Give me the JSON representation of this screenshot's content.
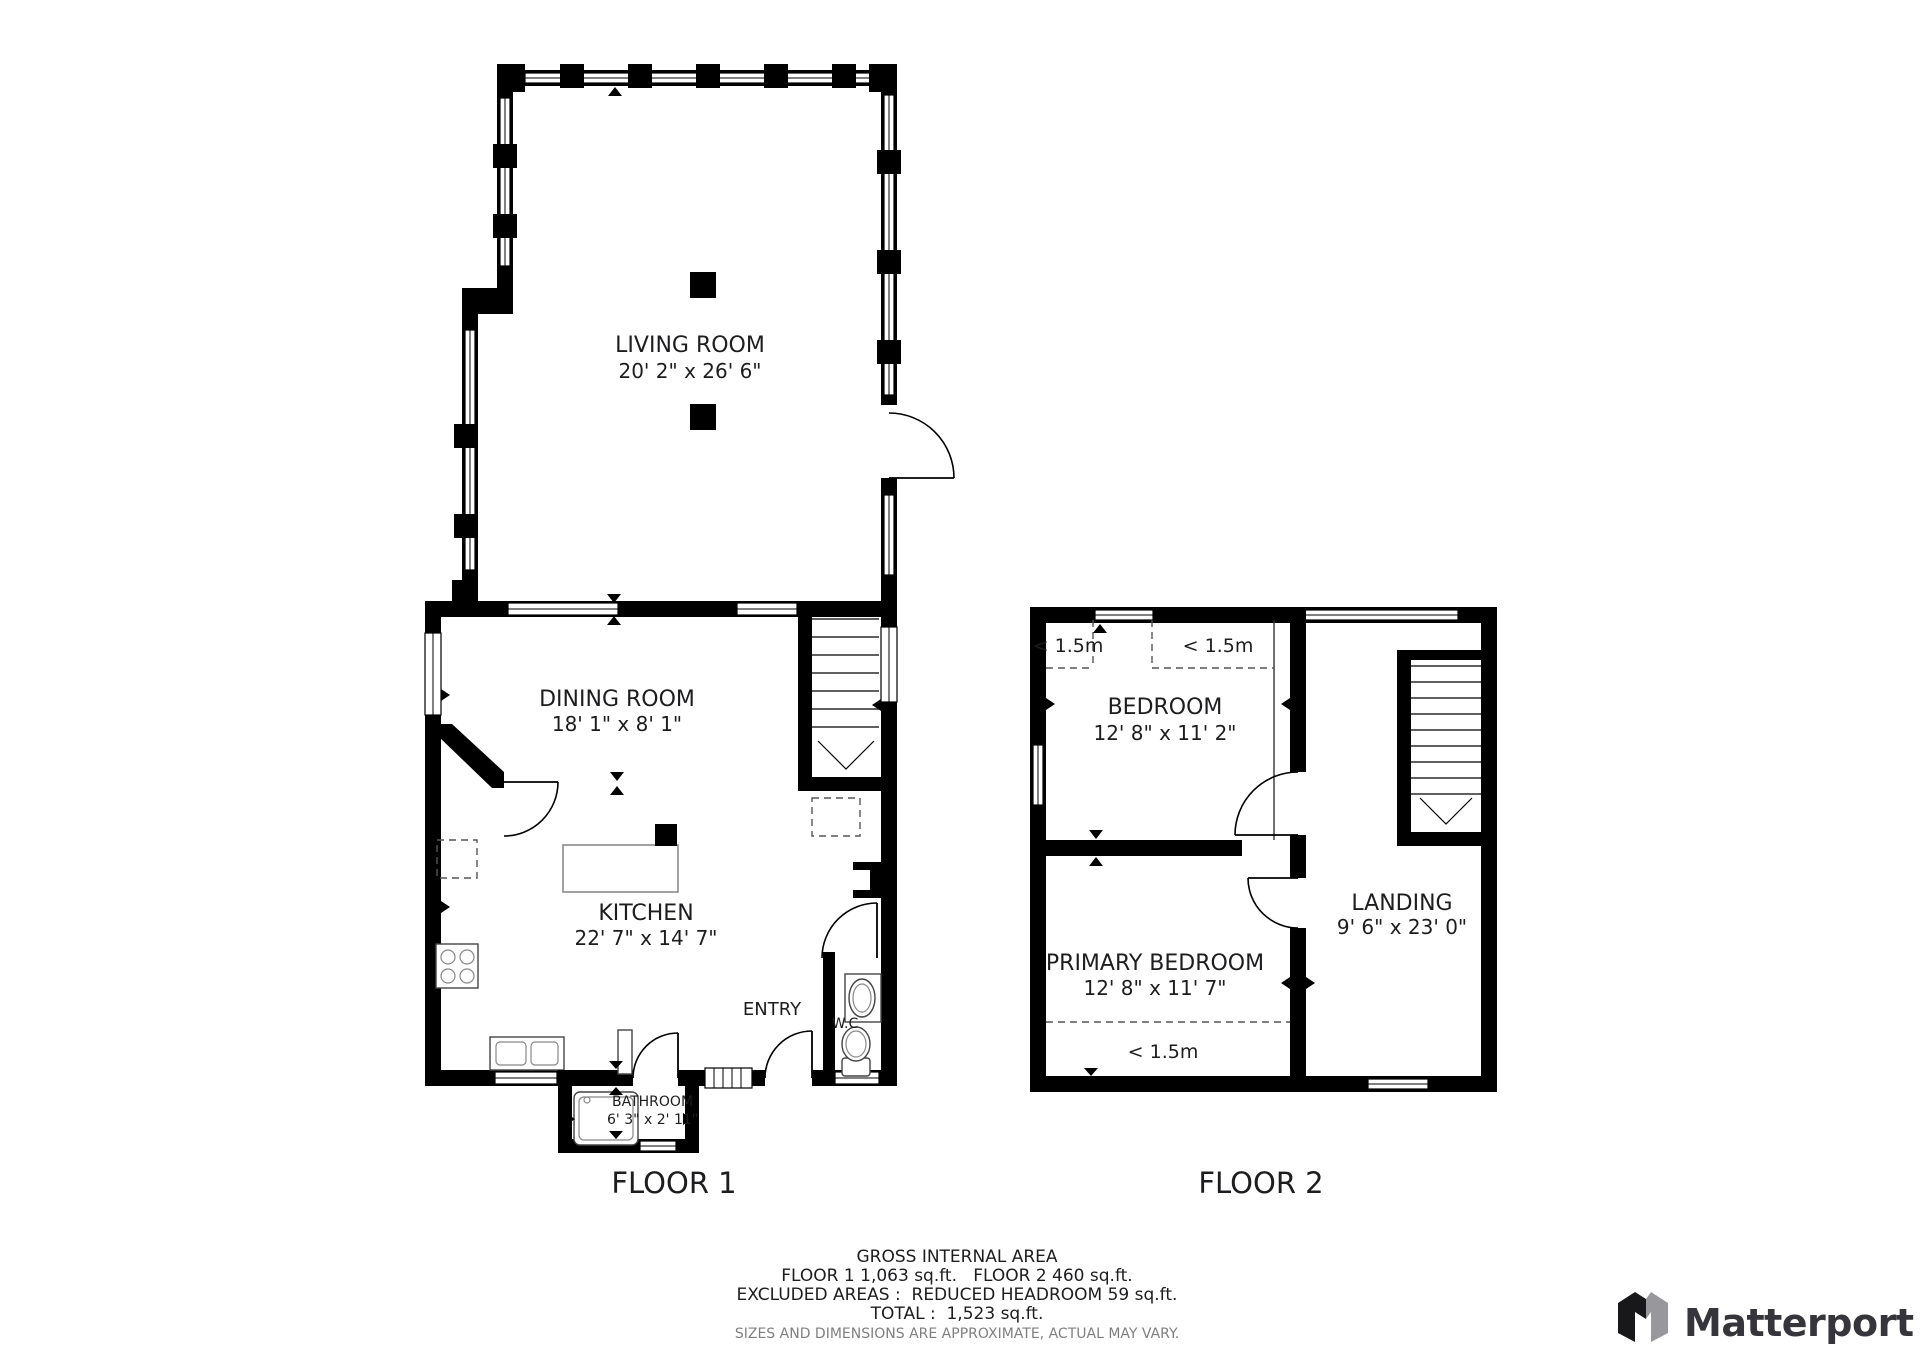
{
  "floor1": {
    "label": "FLOOR 1",
    "living_room": {
      "name": "LIVING ROOM",
      "dims": "20' 2\" x 26' 6\""
    },
    "dining_room": {
      "name": "DINING ROOM",
      "dims": "18' 1\" x 8' 1\""
    },
    "kitchen": {
      "name": "KITCHEN",
      "dims": "22' 7\" x 14' 7\""
    },
    "entry": {
      "name": "ENTRY"
    },
    "wc": {
      "name": "W.C"
    },
    "bathroom": {
      "name": "BATHROOM",
      "dims": "6' 3\" x 2' 11\""
    }
  },
  "floor2": {
    "label": "FLOOR 2",
    "bedroom": {
      "name": "BEDROOM",
      "dims": "12' 8\" x 11' 2\""
    },
    "primary_bedroom": {
      "name": "PRIMARY BEDROOM",
      "dims": "12' 8\" x 11' 7\""
    },
    "landing": {
      "name": "LANDING",
      "dims": "9' 6\" x 23' 0\""
    },
    "headroom_left": "< 1.5m",
    "headroom_center": "< 1.5m",
    "headroom_bottom": "< 1.5m"
  },
  "footer": {
    "title": "GROSS INTERNAL AREA",
    "line1": "FLOOR 1 1,063 sq.ft.   FLOOR 2 460 sq.ft.",
    "line2": "EXCLUDED AREAS :  REDUCED HEADROOM 59 sq.ft.",
    "line3": "TOTAL :  1,523 sq.ft.",
    "disclaimer": "SIZES AND DIMENSIONS ARE APPROXIMATE, ACTUAL MAY VARY."
  },
  "branding": {
    "logo_text": "Matterport"
  },
  "colors": {
    "wall": "#000000",
    "text": "#1d1d1f",
    "muted": "#7f7f7f",
    "fixture": "#444444",
    "logo_dark": "#18181a",
    "logo_gray": "#97979c",
    "logo_text": "#35353b"
  }
}
